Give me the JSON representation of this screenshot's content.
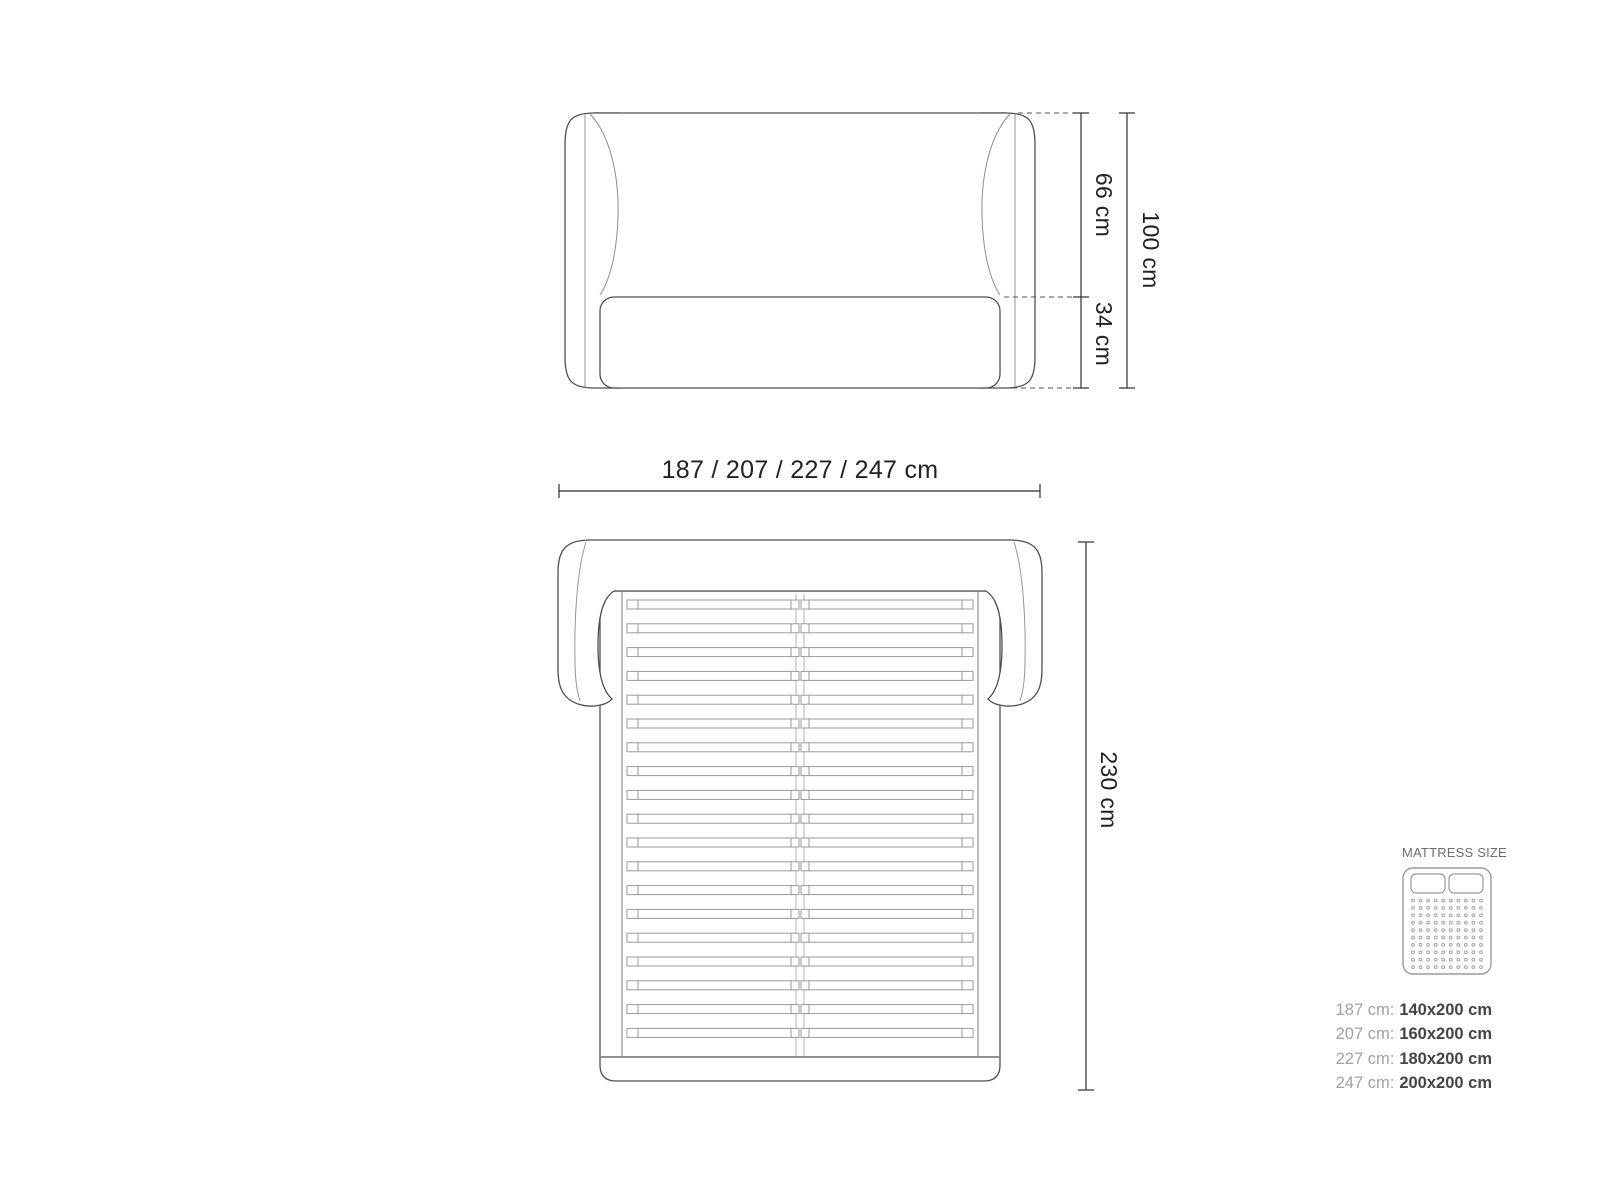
{
  "front_view": {
    "dim_headboard": "66 cm",
    "dim_base": "34 cm",
    "dim_total_height": "100 cm"
  },
  "width_dimension": {
    "label": "187 / 207 / 227 / 247 cm"
  },
  "top_view": {
    "dim_length": "230 cm",
    "slat_count": 19
  },
  "legend": {
    "title": "MATTRESS SIZE",
    "icon": {
      "dot_rows": 10,
      "dot_cols": 10
    },
    "rows": [
      {
        "label": "187 cm:",
        "value": "140x200 cm"
      },
      {
        "label": "207 cm:",
        "value": "160x200 cm"
      },
      {
        "label": "227 cm:",
        "value": "180x200 cm"
      },
      {
        "label": "247 cm:",
        "value": "200x200 cm"
      }
    ]
  },
  "colors": {
    "outline": "#4f4f4f",
    "secondary_line": "#979797",
    "dimension_line": "#2f2f2f",
    "dimension_text": "#222222",
    "legend_title": "#6e6e6e",
    "legend_label": "#a2a2a2",
    "legend_value": "#444444",
    "background": "#ffffff"
  }
}
